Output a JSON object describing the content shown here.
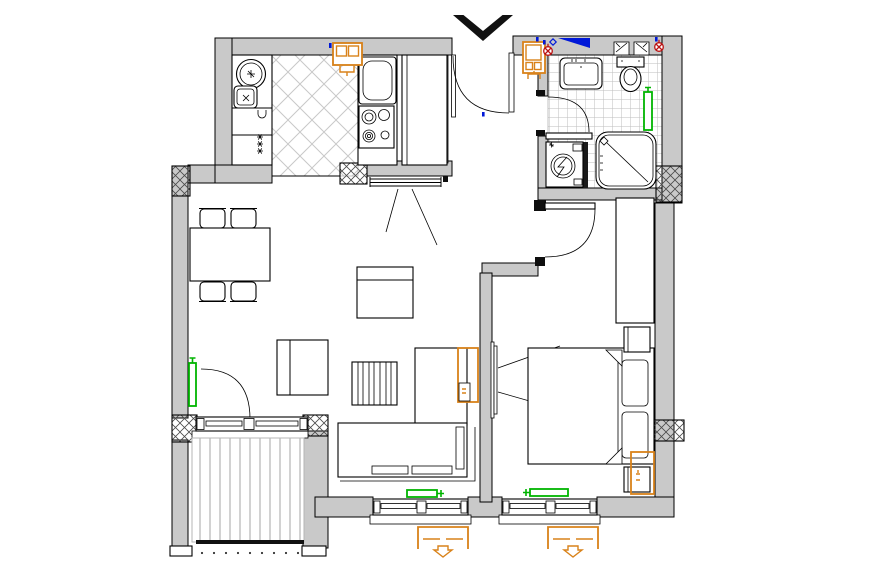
{
  "canvas": {
    "width": 880,
    "height": 580,
    "background": "#ffffff"
  },
  "colors": {
    "line": "#000000",
    "wall-fill": "#c9c9c9",
    "tile-line": "#bdbdbd",
    "diag-line": "#c8c8c8",
    "radiator-green": "#00b400",
    "accent-orange": "#d9821a",
    "accent-blue": "#0018d8",
    "outlet-red": "#bb1111",
    "deck-line": "#b5b5b5"
  },
  "drawing": {
    "type": "apartment-floor-plan",
    "rooms": [
      {
        "name": "kitchen",
        "floor": "diagonal-tile",
        "furniture": [
          "left-counter",
          "round-appliance",
          "sink",
          "fridge",
          "cooktop-4-burner",
          "tall-cabinet",
          "wall-vent-box"
        ]
      },
      {
        "name": "entrance-hall",
        "furniture": [
          "entrance-door",
          "fuse-box"
        ]
      },
      {
        "name": "bathroom",
        "floor": "square-tile",
        "furniture": [
          "washbasin",
          "toilet",
          "washing-machine",
          "shower-tray",
          "radiator",
          "door"
        ]
      },
      {
        "name": "hallway",
        "furniture": [
          "door-to-living",
          "wardrobe-tall"
        ]
      },
      {
        "name": "living-dining-room",
        "furniture": [
          "dining-table",
          "chairs-4",
          "armchair-top",
          "armchair-left",
          "slatted-coffee-table",
          "corner-sofa",
          "wall-tv",
          "radiator-left",
          "radiator-bottom",
          "balcony-door"
        ]
      },
      {
        "name": "bedroom",
        "furniture": [
          "double-bed",
          "pillows-2",
          "nightstand-2",
          "wardrobe",
          "wall-tv",
          "radiator"
        ]
      },
      {
        "name": "balcony",
        "furniture": [
          "plank-deck",
          "sliding-window"
        ]
      }
    ],
    "icons": [
      {
        "name": "entrance-arrow",
        "shape": "chevron-down",
        "color": "#111111"
      },
      {
        "name": "slope-wedge",
        "shape": "right-triangle",
        "color": "#0018d8"
      },
      {
        "name": "power-outlet",
        "shape": "circle-x",
        "color": "#bb1111",
        "count": 2
      },
      {
        "name": "radiator",
        "shape": "green-rect-valve",
        "color": "#00b400",
        "count": 4
      },
      {
        "name": "shutter-awning",
        "shape": "bracket-arrow-down",
        "color": "#d9821a",
        "count": 2
      },
      {
        "name": "fuse-box",
        "shape": "rect-grid",
        "color": "#d9821a",
        "count": 2
      },
      {
        "name": "selection-highlight",
        "shape": "rect-outline",
        "color": "#d9821a",
        "count": 2
      },
      {
        "name": "wall-vent",
        "shape": "rect-flap",
        "count": 2
      },
      {
        "name": "structural-pier",
        "shape": "crosshatch-rect",
        "count": 6
      }
    ]
  }
}
